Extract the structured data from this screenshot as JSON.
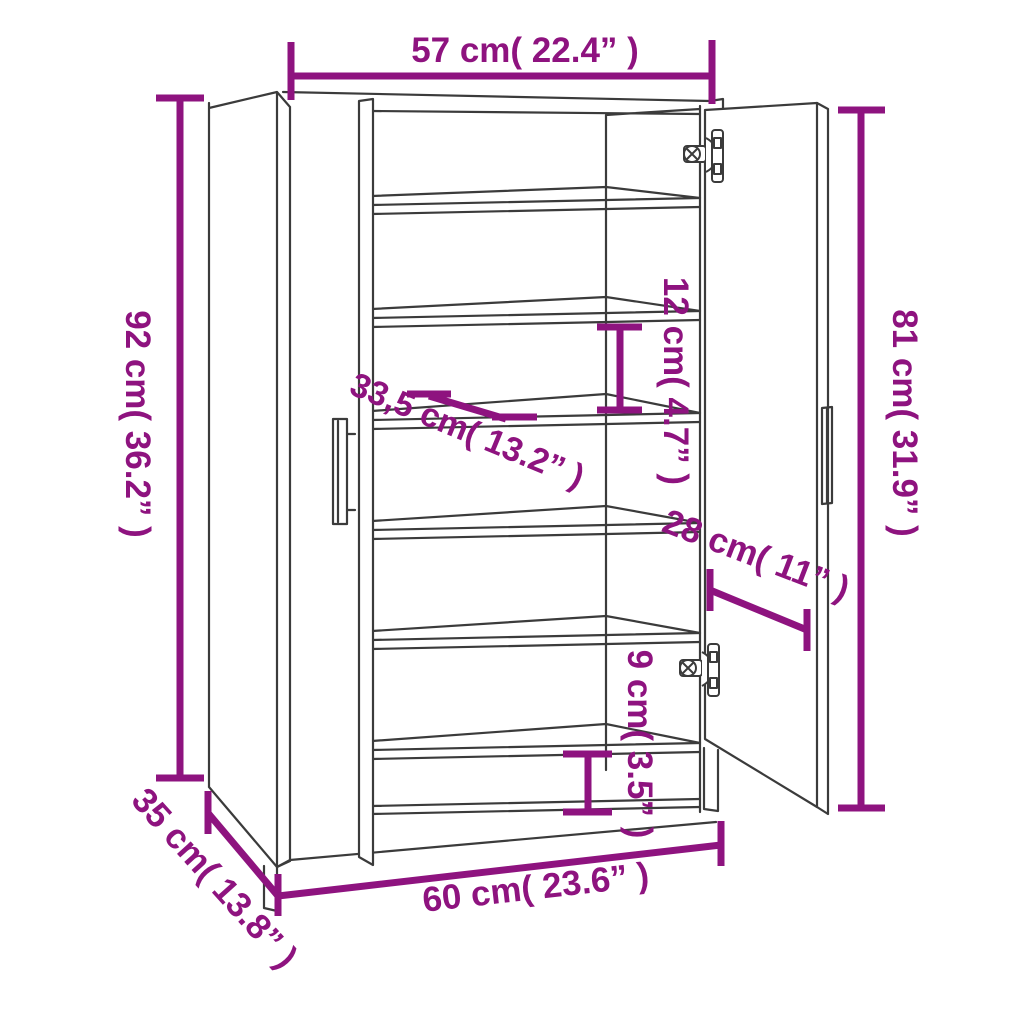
{
  "diagram": {
    "product": "Shoe cabinet line drawing with two open doors, six shelves and dimension arrows",
    "background_color": "#ffffff",
    "line_color": "#3b3b3b",
    "accent_color": "#8E137F",
    "annotations": {
      "top_width": {
        "label": "57 cm( 22.4” )",
        "cm": 57,
        "inch": 22.4
      },
      "left_height": {
        "label": "92 cm( 36.2” )",
        "cm": 92,
        "inch": 36.2
      },
      "right_height": {
        "label": "81 cm( 31.9” )",
        "cm": 81,
        "inch": 31.9
      },
      "shelf_depth": {
        "label": "33,5 cm( 13.2” )",
        "cm": 33.5,
        "inch": 13.2
      },
      "shelf_gap": {
        "label": "12 cm( 4.7” )",
        "cm": 12,
        "inch": 4.7
      },
      "door_width": {
        "label": "28 cm( 11” )",
        "cm": 28,
        "inch": 11
      },
      "bottom_gap": {
        "label": "9 cm( 3.5” )",
        "cm": 9,
        "inch": 3.5
      },
      "side_depth": {
        "label": "35 cm( 13.8” )",
        "cm": 35,
        "inch": 13.8
      },
      "bottom_width": {
        "label": "60 cm( 23.6” )",
        "cm": 60,
        "inch": 23.6
      }
    }
  }
}
